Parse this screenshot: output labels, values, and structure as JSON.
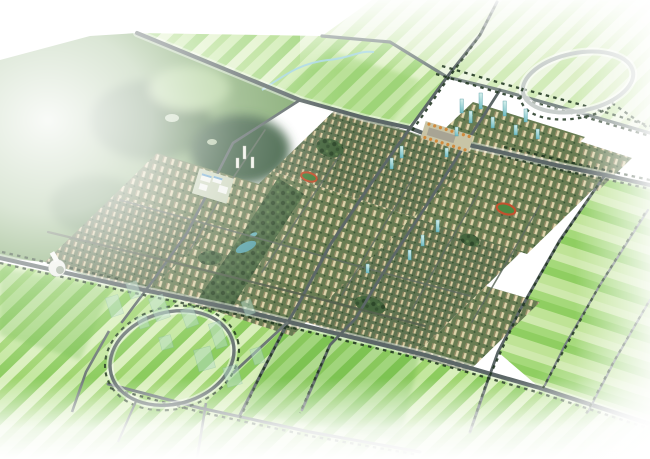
{
  "image": {
    "type": "aerial-masterplan-rendering",
    "description": "Photorealistic bird's-eye architectural rendering of a planned urban district. A diagonal band of tan residential blocks with glass towers and tree-lined avenues stretches from lower-left to upper-right, flanked by striped green farmland, a forested hill at the upper left, a circular ring road at the upper right, and a crescent plaza with translucent future-phase buildings at the lower left. The scene fades to white at the edges.",
    "visible_text": "none"
  },
  "colors": {
    "background": "#ffffff",
    "field_pale": "#eef7e2",
    "field_light": "#d9efbb",
    "field_mid": "#b9e18e",
    "field_bright": "#8ccc5e",
    "field_deep": "#63b43e",
    "forest_base": "#7fa76c",
    "forest_dark": "#46703f",
    "forest_deep": "#35583a",
    "forest_light": "#a9cc90",
    "road": "#5c6767",
    "road_pale": "#7e8a87",
    "ring_road": "#c9cfcc",
    "tree_line": "#203620",
    "city_ground": "#687c52",
    "building_tan": "#ded4ab",
    "building_shadow": "#8d805c",
    "tower_teal": "#6fbcc4",
    "tower_teal_light": "#d6f0ec",
    "white_building": "#f2f3ec",
    "ghost_building": "#b7dcc8",
    "park_green": "#46663e",
    "park_dark": "#2d4729",
    "pond_teal": "#57a0a6",
    "track_orange": "#c2512f",
    "plaza_tan": "#c8c4a6",
    "plaza_tree_orange": "#d08a3c",
    "roof_blue": "#6fa8cf",
    "creek_blue": "#a5d6e6",
    "haze": "#ffffff"
  },
  "scene": {
    "regions": {
      "forest": {
        "name": "forest-hills",
        "description": "Mottled green forested hills at the upper left, fading into white haze"
      },
      "fields_north": {
        "name": "north-farmland",
        "description": "Pale striped farmland parcels north of the main road, crossed by a small blue creek"
      },
      "fields_east": {
        "name": "east-farmland",
        "description": "Bright striped farmland east of the city, divided by tree-lined roads"
      },
      "fields_south": {
        "name": "south-farmland",
        "description": "Striped farmland south of the city fading to white at the bottom edge"
      },
      "ring_road": {
        "name": "ring-road",
        "description": "Large circular ring road at the upper right, partly faded to white, lined with trees on its lower arc"
      },
      "city": {
        "name": "city-band",
        "description": "Dense diagonal band of tan residential slab buildings with olive-green courtyards"
      },
      "park": {
        "name": "central-park",
        "description": "Central landscape park spine with dense dark trees and a small teal pond"
      },
      "plaza": {
        "name": "civic-plaza",
        "description": "Central paved plaza with rows of orange trees"
      },
      "campus": {
        "name": "civic-campus",
        "description": "White flat-roofed campus buildings with blue roof panels"
      },
      "towers": {
        "name": "glass-tower-cluster",
        "description": "Cluster of teal glass high-rise towers near the northern avenue"
      },
      "tracks": {
        "name": "sports-fields",
        "description": "Small stadium fields with orange running tracks"
      },
      "crescent": {
        "name": "crescent-plaza",
        "description": "Circular crescent road at the lower left surrounded by translucent future-phase buildings"
      },
      "ghosts": {
        "name": "future-phase-buildings",
        "description": "Semi-transparent massing models of unbuilt buildings"
      },
      "landmark": {
        "name": "landmark-building",
        "description": "White curved landmark building at the western tip of the city"
      },
      "creek": {
        "name": "creek",
        "description": "Small light-blue creek meandering through the north fields"
      },
      "roads": {
        "name": "road-network",
        "description": "Diagonal grid of grey arterial roads flanked by dark tree lines"
      }
    }
  }
}
